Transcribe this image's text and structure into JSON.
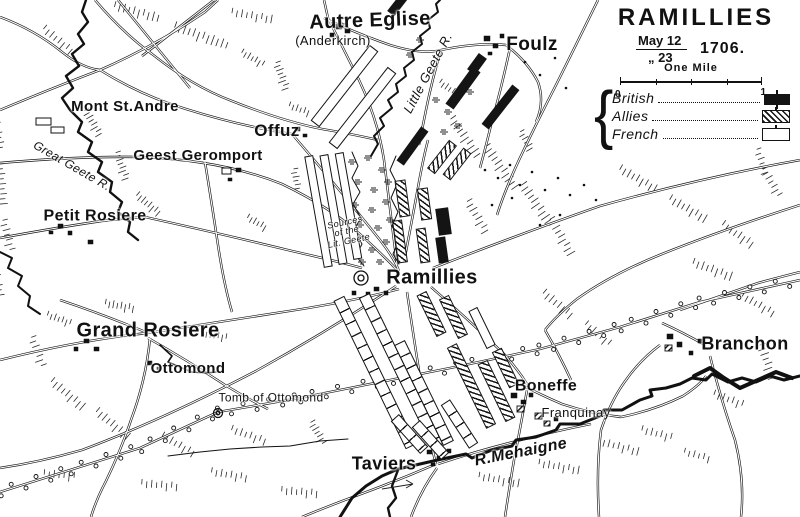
{
  "colors": {
    "ink": "#1a1a1a",
    "paper": "#ffffff"
  },
  "title_block": {
    "title": "RAMILLIES",
    "date_line1": "May 12",
    "date_line2": "„ 23",
    "year": "1706.",
    "scale_label": "One Mile",
    "scale_left": "0",
    "scale_right": "1"
  },
  "legend": {
    "items": [
      {
        "label": "British",
        "type": "british"
      },
      {
        "label": "Allies",
        "type": "allies"
      },
      {
        "label": "French",
        "type": "french"
      }
    ]
  },
  "places": [
    {
      "id": "autre-eglise",
      "label": "Autre Eglise",
      "x": 370,
      "y": 21,
      "size": 20,
      "rot": -2
    },
    {
      "id": "anderkirch",
      "label": "(Anderkirch)",
      "x": 333,
      "y": 41,
      "size": 13,
      "weight": 400
    },
    {
      "id": "foulz",
      "label": "Foulz",
      "x": 532,
      "y": 45,
      "size": 19
    },
    {
      "id": "mont-st-andre",
      "label": "Mont St.Andre",
      "x": 125,
      "y": 107,
      "size": 15
    },
    {
      "id": "offuz",
      "label": "Offuz",
      "x": 277,
      "y": 131,
      "size": 17
    },
    {
      "id": "geest-geromport",
      "label": "Geest Geromport",
      "x": 198,
      "y": 156,
      "size": 15
    },
    {
      "id": "great-geete-r",
      "label": "Great Geete R.",
      "x": 72,
      "y": 166,
      "size": 12,
      "rot": 30,
      "italic": true,
      "weight": 400
    },
    {
      "id": "petit-rosiere",
      "label": "Petit Rosiere",
      "x": 95,
      "y": 217,
      "size": 16
    },
    {
      "id": "sources-lit-geete",
      "label": "Sources\nof the\nLit. Geete",
      "x": 347,
      "y": 232,
      "size": 9,
      "rot": -12,
      "italic": true,
      "weight": 400
    },
    {
      "id": "little-geete-r",
      "label": "Little Geete R.",
      "x": 428,
      "y": 73,
      "size": 13,
      "rot": -62,
      "italic": true,
      "weight": 400
    },
    {
      "id": "ramillies",
      "label": "Ramillies",
      "x": 432,
      "y": 278,
      "size": 20
    },
    {
      "id": "grand-rosiere",
      "label": "Grand Rosiere",
      "x": 148,
      "y": 331,
      "size": 20
    },
    {
      "id": "ottomond",
      "label": "Ottomond",
      "x": 188,
      "y": 369,
      "size": 15
    },
    {
      "id": "tomb-of-ottomond",
      "label": "Tomb of Ottomond",
      "x": 271,
      "y": 398,
      "size": 12,
      "weight": 400
    },
    {
      "id": "boneffe",
      "label": "Boneffe",
      "x": 546,
      "y": 387,
      "size": 16
    },
    {
      "id": "franquinay",
      "label": "Franquinay",
      "x": 576,
      "y": 413,
      "size": 13,
      "weight": 400
    },
    {
      "id": "branchon",
      "label": "Branchon",
      "x": 745,
      "y": 344,
      "size": 18
    },
    {
      "id": "taviers",
      "label": "Taviers",
      "x": 384,
      "y": 464,
      "size": 18
    },
    {
      "id": "r-mehaigne",
      "label": "R.Mehaigne",
      "x": 521,
      "y": 453,
      "size": 16,
      "rot": -11,
      "italic": true
    }
  ],
  "formations": [
    {
      "type": "french",
      "cx": 344,
      "cy": 86,
      "len": 96,
      "w": 11,
      "rot": 38
    },
    {
      "type": "french",
      "cx": 362,
      "cy": 108,
      "len": 96,
      "w": 11,
      "rot": 38
    },
    {
      "type": "french",
      "cx": 318,
      "cy": 211,
      "len": 113,
      "w": 9,
      "rot": -10
    },
    {
      "type": "french",
      "cx": 333,
      "cy": 209,
      "len": 111,
      "w": 9,
      "rot": -10
    },
    {
      "type": "french",
      "cx": 348,
      "cy": 206,
      "len": 108,
      "w": 9,
      "rot": -10
    },
    {
      "type": "french-col",
      "cx": 375,
      "cy": 372,
      "len": 165,
      "w": 12,
      "rot": -26
    },
    {
      "type": "french-col",
      "cx": 401,
      "cy": 371,
      "len": 168,
      "w": 12,
      "rot": -26
    },
    {
      "type": "french-col",
      "cx": 424,
      "cy": 393,
      "len": 112,
      "w": 12,
      "rot": -26
    },
    {
      "type": "french-col",
      "cx": 459,
      "cy": 424,
      "len": 52,
      "w": 11,
      "rot": -33
    },
    {
      "type": "french",
      "cx": 482,
      "cy": 328,
      "len": 42,
      "w": 10,
      "rot": -26
    },
    {
      "type": "french-col",
      "cx": 409,
      "cy": 434,
      "len": 44,
      "w": 11,
      "rot": -42
    },
    {
      "type": "french-col",
      "cx": 430,
      "cy": 440,
      "len": 44,
      "w": 11,
      "rot": -42
    },
    {
      "type": "allies",
      "cx": 442,
      "cy": 157,
      "len": 36,
      "w": 10,
      "rot": 38
    },
    {
      "type": "allies",
      "cx": 457,
      "cy": 164,
      "len": 34,
      "w": 10,
      "rot": 38
    },
    {
      "type": "allies",
      "cx": 402,
      "cy": 198,
      "len": 37,
      "w": 11,
      "rot": -8
    },
    {
      "type": "allies",
      "cx": 400,
      "cy": 241,
      "len": 43,
      "w": 10,
      "rot": -8
    },
    {
      "type": "allies",
      "cx": 424,
      "cy": 204,
      "len": 32,
      "w": 11,
      "rot": -8
    },
    {
      "type": "allies",
      "cx": 423,
      "cy": 245,
      "len": 35,
      "w": 10,
      "rot": -8
    },
    {
      "type": "allies",
      "cx": 431,
      "cy": 314,
      "len": 46,
      "w": 11,
      "rot": -26
    },
    {
      "type": "allies",
      "cx": 453,
      "cy": 317,
      "len": 44,
      "w": 11,
      "rot": -26
    },
    {
      "type": "allies",
      "cx": 471,
      "cy": 386,
      "len": 90,
      "w": 11,
      "rot": -26
    },
    {
      "type": "allies",
      "cx": 496,
      "cy": 391,
      "len": 64,
      "w": 11,
      "rot": -26
    },
    {
      "type": "allies",
      "cx": 505,
      "cy": 368,
      "len": 40,
      "w": 11,
      "rot": -26
    },
    {
      "type": "british",
      "cx": 397,
      "cy": 5,
      "len": 22,
      "w": 9,
      "rot": 38
    },
    {
      "type": "british",
      "cx": 477,
      "cy": 64,
      "len": 20,
      "w": 10,
      "rot": 36
    },
    {
      "type": "british",
      "cx": 463,
      "cy": 88,
      "len": 46,
      "w": 10,
      "rot": 36
    },
    {
      "type": "british",
      "cx": 500,
      "cy": 107,
      "len": 50,
      "w": 9,
      "rot": 38
    },
    {
      "type": "british",
      "cx": 412,
      "cy": 146,
      "len": 42,
      "w": 9,
      "rot": 36
    },
    {
      "type": "british",
      "cx": 443,
      "cy": 221,
      "len": 27,
      "w": 13,
      "rot": -8
    },
    {
      "type": "british",
      "cx": 442,
      "cy": 250,
      "len": 26,
      "w": 10,
      "rot": -8
    }
  ]
}
